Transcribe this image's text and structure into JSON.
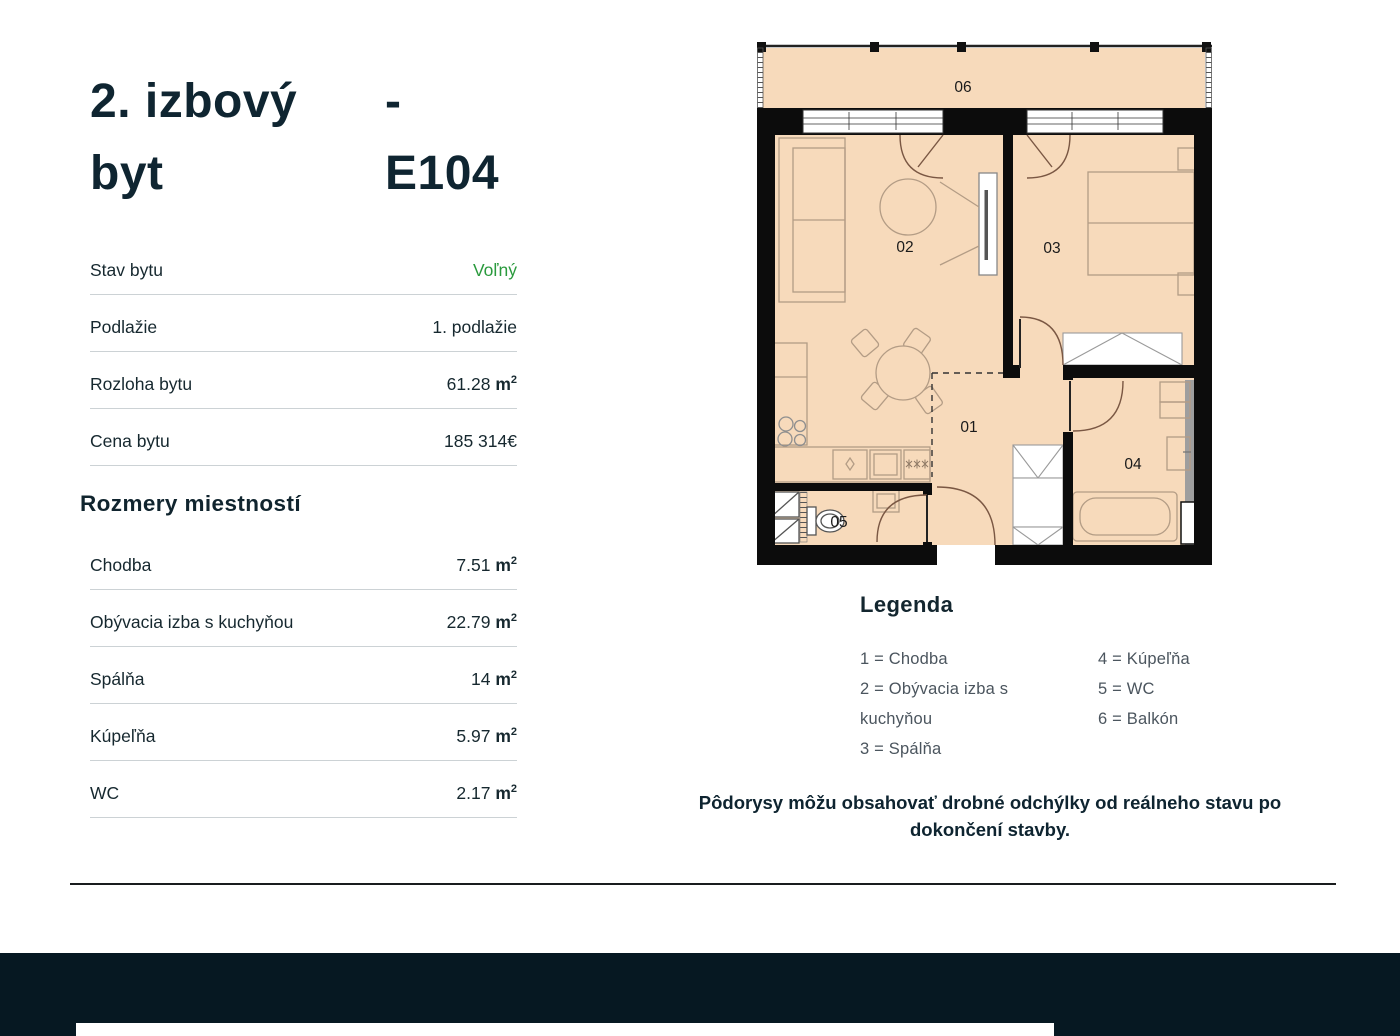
{
  "page": {
    "title_type": "2. izbový byt",
    "title_code": "- E104"
  },
  "details": [
    {
      "label": "Stav bytu",
      "value": "Voľný",
      "style": "green"
    },
    {
      "label": "Podlažie",
      "value": "1. podlažie"
    },
    {
      "label": "Rozloha bytu",
      "value": "61.28",
      "unit": "m2"
    },
    {
      "label": "Cena bytu",
      "value": "185 314€"
    }
  ],
  "rooms_heading": "Rozmery miestností",
  "rooms": [
    {
      "label": "Chodba",
      "value": "7.51",
      "unit": "m2"
    },
    {
      "label": "Obývacia izba s kuchyňou",
      "value": "22.79",
      "unit": "m2"
    },
    {
      "label": "Spálňa",
      "value": "14",
      "unit": "m2"
    },
    {
      "label": "Kúpeľňa",
      "value": "5.97",
      "unit": "m2"
    },
    {
      "label": "WC",
      "value": "2.17",
      "unit": "m2"
    }
  ],
  "plan": {
    "room_labels": {
      "r01": "01",
      "r02": "02",
      "r03": "03",
      "r04": "04",
      "r05": "05",
      "r06": "06"
    }
  },
  "legend": {
    "heading": "Legenda",
    "left": [
      "1 = Chodba",
      "2 = Obývacia izba s kuchyňou",
      "3 = Spálňa"
    ],
    "right": [
      "4 = Kúpeľňa",
      "5 = WC",
      "6 = Balkón"
    ]
  },
  "note": "Pôdorysy môžu obsahovať drobné odchýlky od reálneho stavu po dokončení stavby.",
  "colors": {
    "accent_green": "#2a9a3d",
    "floor": "#f7dabb",
    "wall": "#0c0c0c",
    "footer": "#061822"
  }
}
